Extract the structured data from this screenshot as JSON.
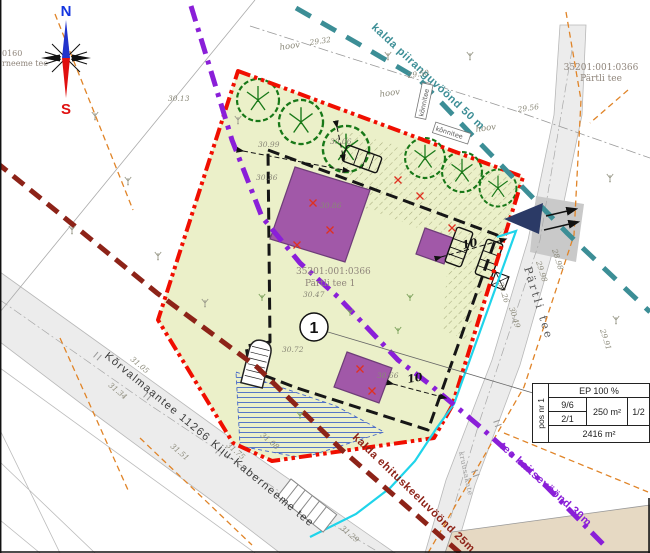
{
  "compass": {
    "north": "N",
    "south": "S"
  },
  "zones": {
    "piirang": "kalda piiranguvöönd 50 m",
    "keeld": "kalda ehituskeeluvöönd 25m",
    "tee": "tee kaitsevöönd 30m"
  },
  "roads": {
    "main": "Kõrvalmaantee 11266 Kiiu-Kaberneeme tee",
    "partli": "Pärtli tee",
    "surface": "kruusakate",
    "left_edge_line1": "0160",
    "left_edge_line2": "rneeme tee"
  },
  "parcels": {
    "northeast": {
      "code": "35201:001:0366",
      "name": "Pärtli tee"
    },
    "subject": {
      "code": "35201:001:0366",
      "name": "Pärtli tee 1"
    }
  },
  "plot_number": "1",
  "dim_labels": [
    "10",
    "10"
  ],
  "hoov_labels": [
    "hoov",
    "hoov",
    "hoov"
  ],
  "boxed_labels": [
    "kõnnitee",
    "kõnnitee"
  ],
  "table": {
    "pos": "pos nr 1",
    "ep": "EP 100 %",
    "floors_a": "9/6",
    "floors_b": "2/1",
    "area_building": "250 m²",
    "ratio": "1/2",
    "area_plot": "2416 m²"
  },
  "elevations": [
    {
      "t": "30.13",
      "x": 168,
      "y": 101,
      "r": 0
    },
    {
      "t": "29.32",
      "x": 310,
      "y": 45,
      "r": -8
    },
    {
      "t": "29.50",
      "x": 408,
      "y": 78,
      "r": -8
    },
    {
      "t": "29.56",
      "x": 518,
      "y": 112,
      "r": -8
    },
    {
      "t": "30.06",
      "x": 330,
      "y": 144,
      "r": 0
    },
    {
      "t": "30.99",
      "x": 258,
      "y": 147,
      "r": 0
    },
    {
      "t": "30.36",
      "x": 256,
      "y": 180,
      "r": 0
    },
    {
      "t": "30.86",
      "x": 320,
      "y": 208,
      "r": 0
    },
    {
      "t": "30.47",
      "x": 303,
      "y": 297,
      "r": 0
    },
    {
      "t": "30.72",
      "x": 282,
      "y": 352,
      "r": 0
    },
    {
      "t": "30.66",
      "x": 377,
      "y": 378,
      "r": 0
    },
    {
      "t": "30.26",
      "x": 498,
      "y": 283,
      "r": 72
    },
    {
      "t": "30.49",
      "x": 509,
      "y": 308,
      "r": 72
    },
    {
      "t": "29.98",
      "x": 536,
      "y": 262,
      "r": 72
    },
    {
      "t": "28.98",
      "x": 552,
      "y": 250,
      "r": 72
    },
    {
      "t": "29.91",
      "x": 600,
      "y": 330,
      "r": 72
    },
    {
      "t": "31.05",
      "x": 130,
      "y": 360,
      "r": 40
    },
    {
      "t": "31.34",
      "x": 108,
      "y": 386,
      "r": 40
    },
    {
      "t": "31.51",
      "x": 170,
      "y": 447,
      "r": 40
    },
    {
      "t": "31.75",
      "x": 226,
      "y": 446,
      "r": 40
    },
    {
      "t": "31.08",
      "x": 260,
      "y": 436,
      "r": 40
    },
    {
      "t": "31.29",
      "x": 340,
      "y": 529,
      "r": 40
    }
  ],
  "colors": {
    "plot_fill": "#ebf0c9",
    "boundary_red": "#f00e00",
    "zone_teal": "#3c8e96",
    "zone_violet": "#8a1fd8",
    "zone_maroon": "#8d2318",
    "utility_cyan": "#1fd4ea",
    "cadastral_orange": "#e08428",
    "building_purple": "#a158a8",
    "tree_green": "#187818",
    "entrance_navy": "#2b3a66"
  }
}
